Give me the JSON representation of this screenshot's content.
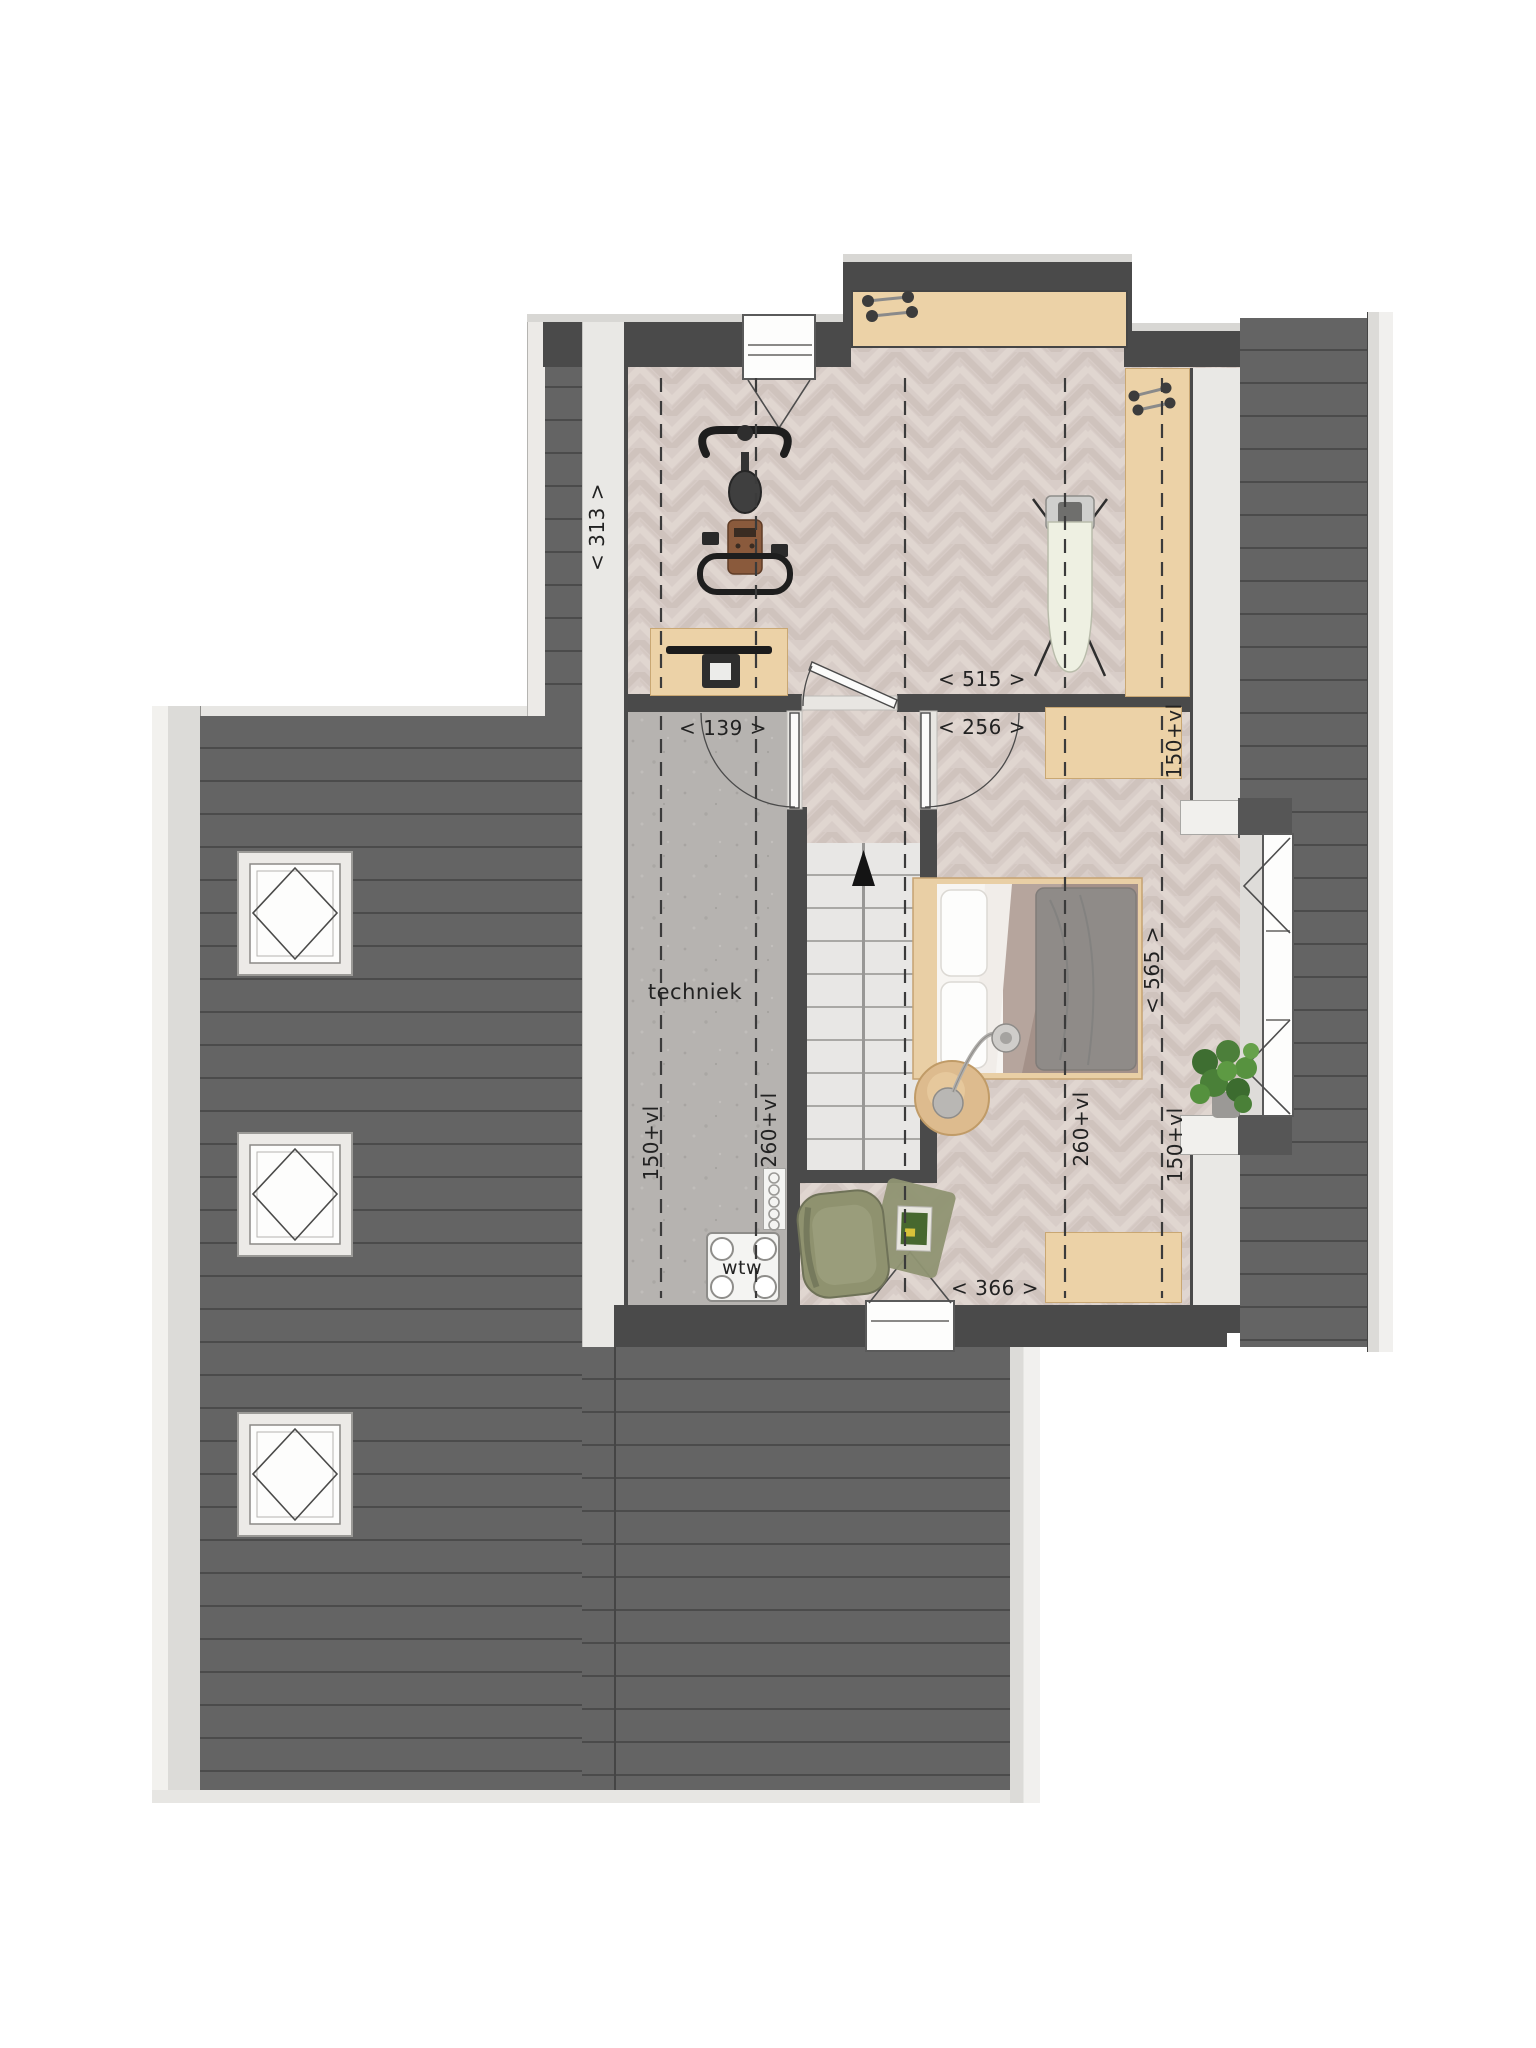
{
  "document": {
    "type": "floor-plan",
    "style": "furnished attic storey top view"
  },
  "labels": {
    "room_techniek": "techniek",
    "unit_wtw": "wtw",
    "dim_139": "< 139 >",
    "dim_515": "< 515 >",
    "dim_256": "< 256 >",
    "dim_366": "< 366 >",
    "dim_313": "< 313 >",
    "dim_565": "< 565 >",
    "clearance_150_left": "150+vl",
    "clearance_260_left": "260+vl",
    "clearance_260_right": "260+vl",
    "clearance_150_right_top": "150+vl",
    "clearance_150_right_bottom": "150+vl"
  },
  "colors": {
    "background": "#ffffff",
    "roof_plank": "#646464",
    "roof_plank_line": "#4b4b4b",
    "wall_dark": "#4a4a4a",
    "trim_light": "#e7e6e3",
    "interior_wall_light": "#e9e8e5",
    "wood_floor": "#d8cdc8",
    "concrete_floor": "#b6b3b0",
    "furniture_wood": "#ecd2a7",
    "stairs": "#e8e7e5",
    "dimension_text": "#222222",
    "bed_duvet": "#8f8b88",
    "bed_blanket": "#a49189",
    "armchair": "#8f926f",
    "plant": "#4c7f3a"
  },
  "furniture_icons": [
    "exercise-bike-icon",
    "dumbbells-icon",
    "ironing-board-icon",
    "desk-monitor-icon",
    "bed-icon",
    "floor-lamp-icon",
    "side-table-icon",
    "armchair-icon",
    "rug-magazine-icon",
    "plant-icon",
    "wtw-unit-icon",
    "vent-grille-icon",
    "stairs-up-icon",
    "skylight-icon"
  ]
}
